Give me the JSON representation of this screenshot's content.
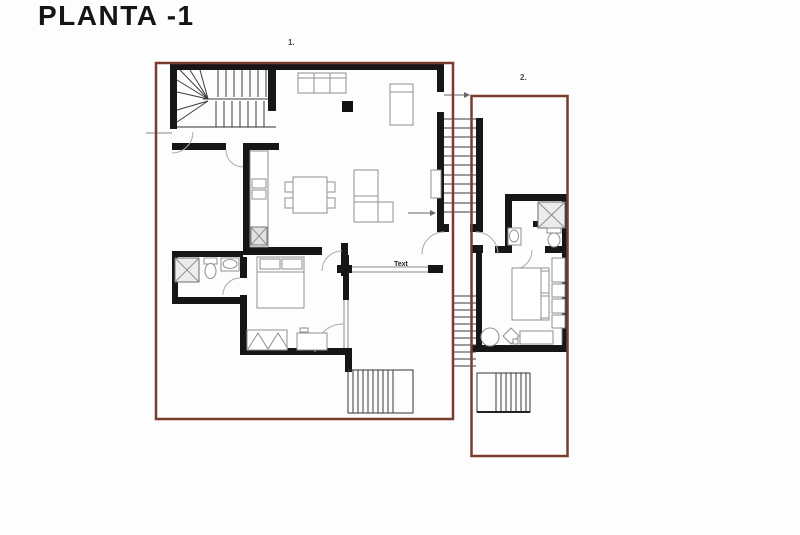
{
  "title": "PLANTA -1",
  "plan": {
    "zone1_label": "1.",
    "zone2_label": "2.",
    "annotation": "Text"
  },
  "colors": {
    "zone_border": "#7d3b2d",
    "wall": "#161616",
    "furniture_outline": "#8f8f8f",
    "title_color": "#151515"
  }
}
